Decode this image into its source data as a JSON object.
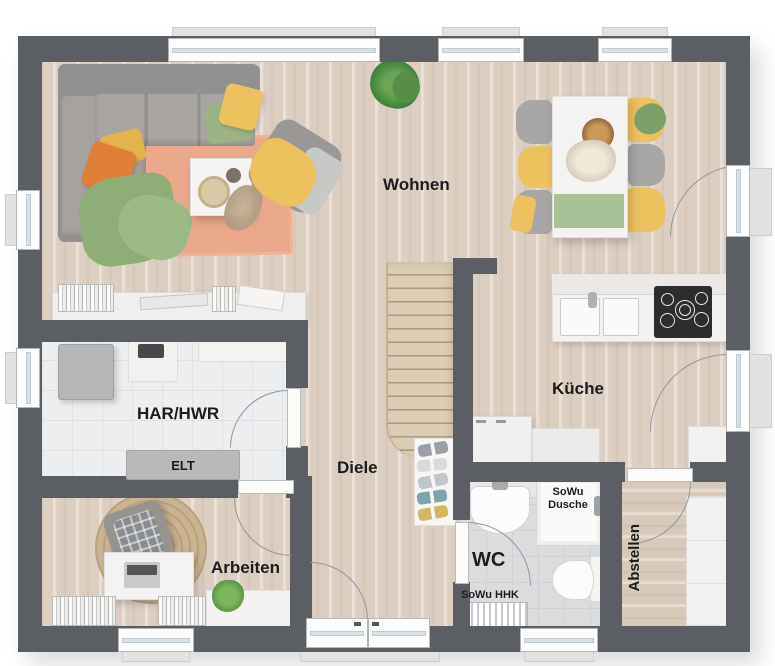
{
  "rooms": {
    "wohnen": "Wohnen",
    "kueche": "Küche",
    "har_hwr": "HAR/HWR",
    "elt": "ELT",
    "diele": "Diele",
    "arbeiten": "Arbeiten",
    "wc": "WC",
    "abstellen": "Abstellen"
  },
  "annotations": {
    "shower_line1": "SoWu",
    "shower_line2": "Dusche",
    "heater": "SoWu HHK"
  },
  "colors": {
    "wall": "#5b5e62",
    "wood_floor": "#dccfc2",
    "har_tile": "#edeef0",
    "wc_tile": "#dadcde",
    "rug_salmon": "#eba989",
    "sofa_gray": "#9b9997",
    "accent_yellow": "#ecc25f",
    "accent_green": "#9cb383",
    "accent_orange": "#e07f35",
    "counter_white": "#f3f2f0",
    "cooktop_black": "#2d2d2f"
  }
}
